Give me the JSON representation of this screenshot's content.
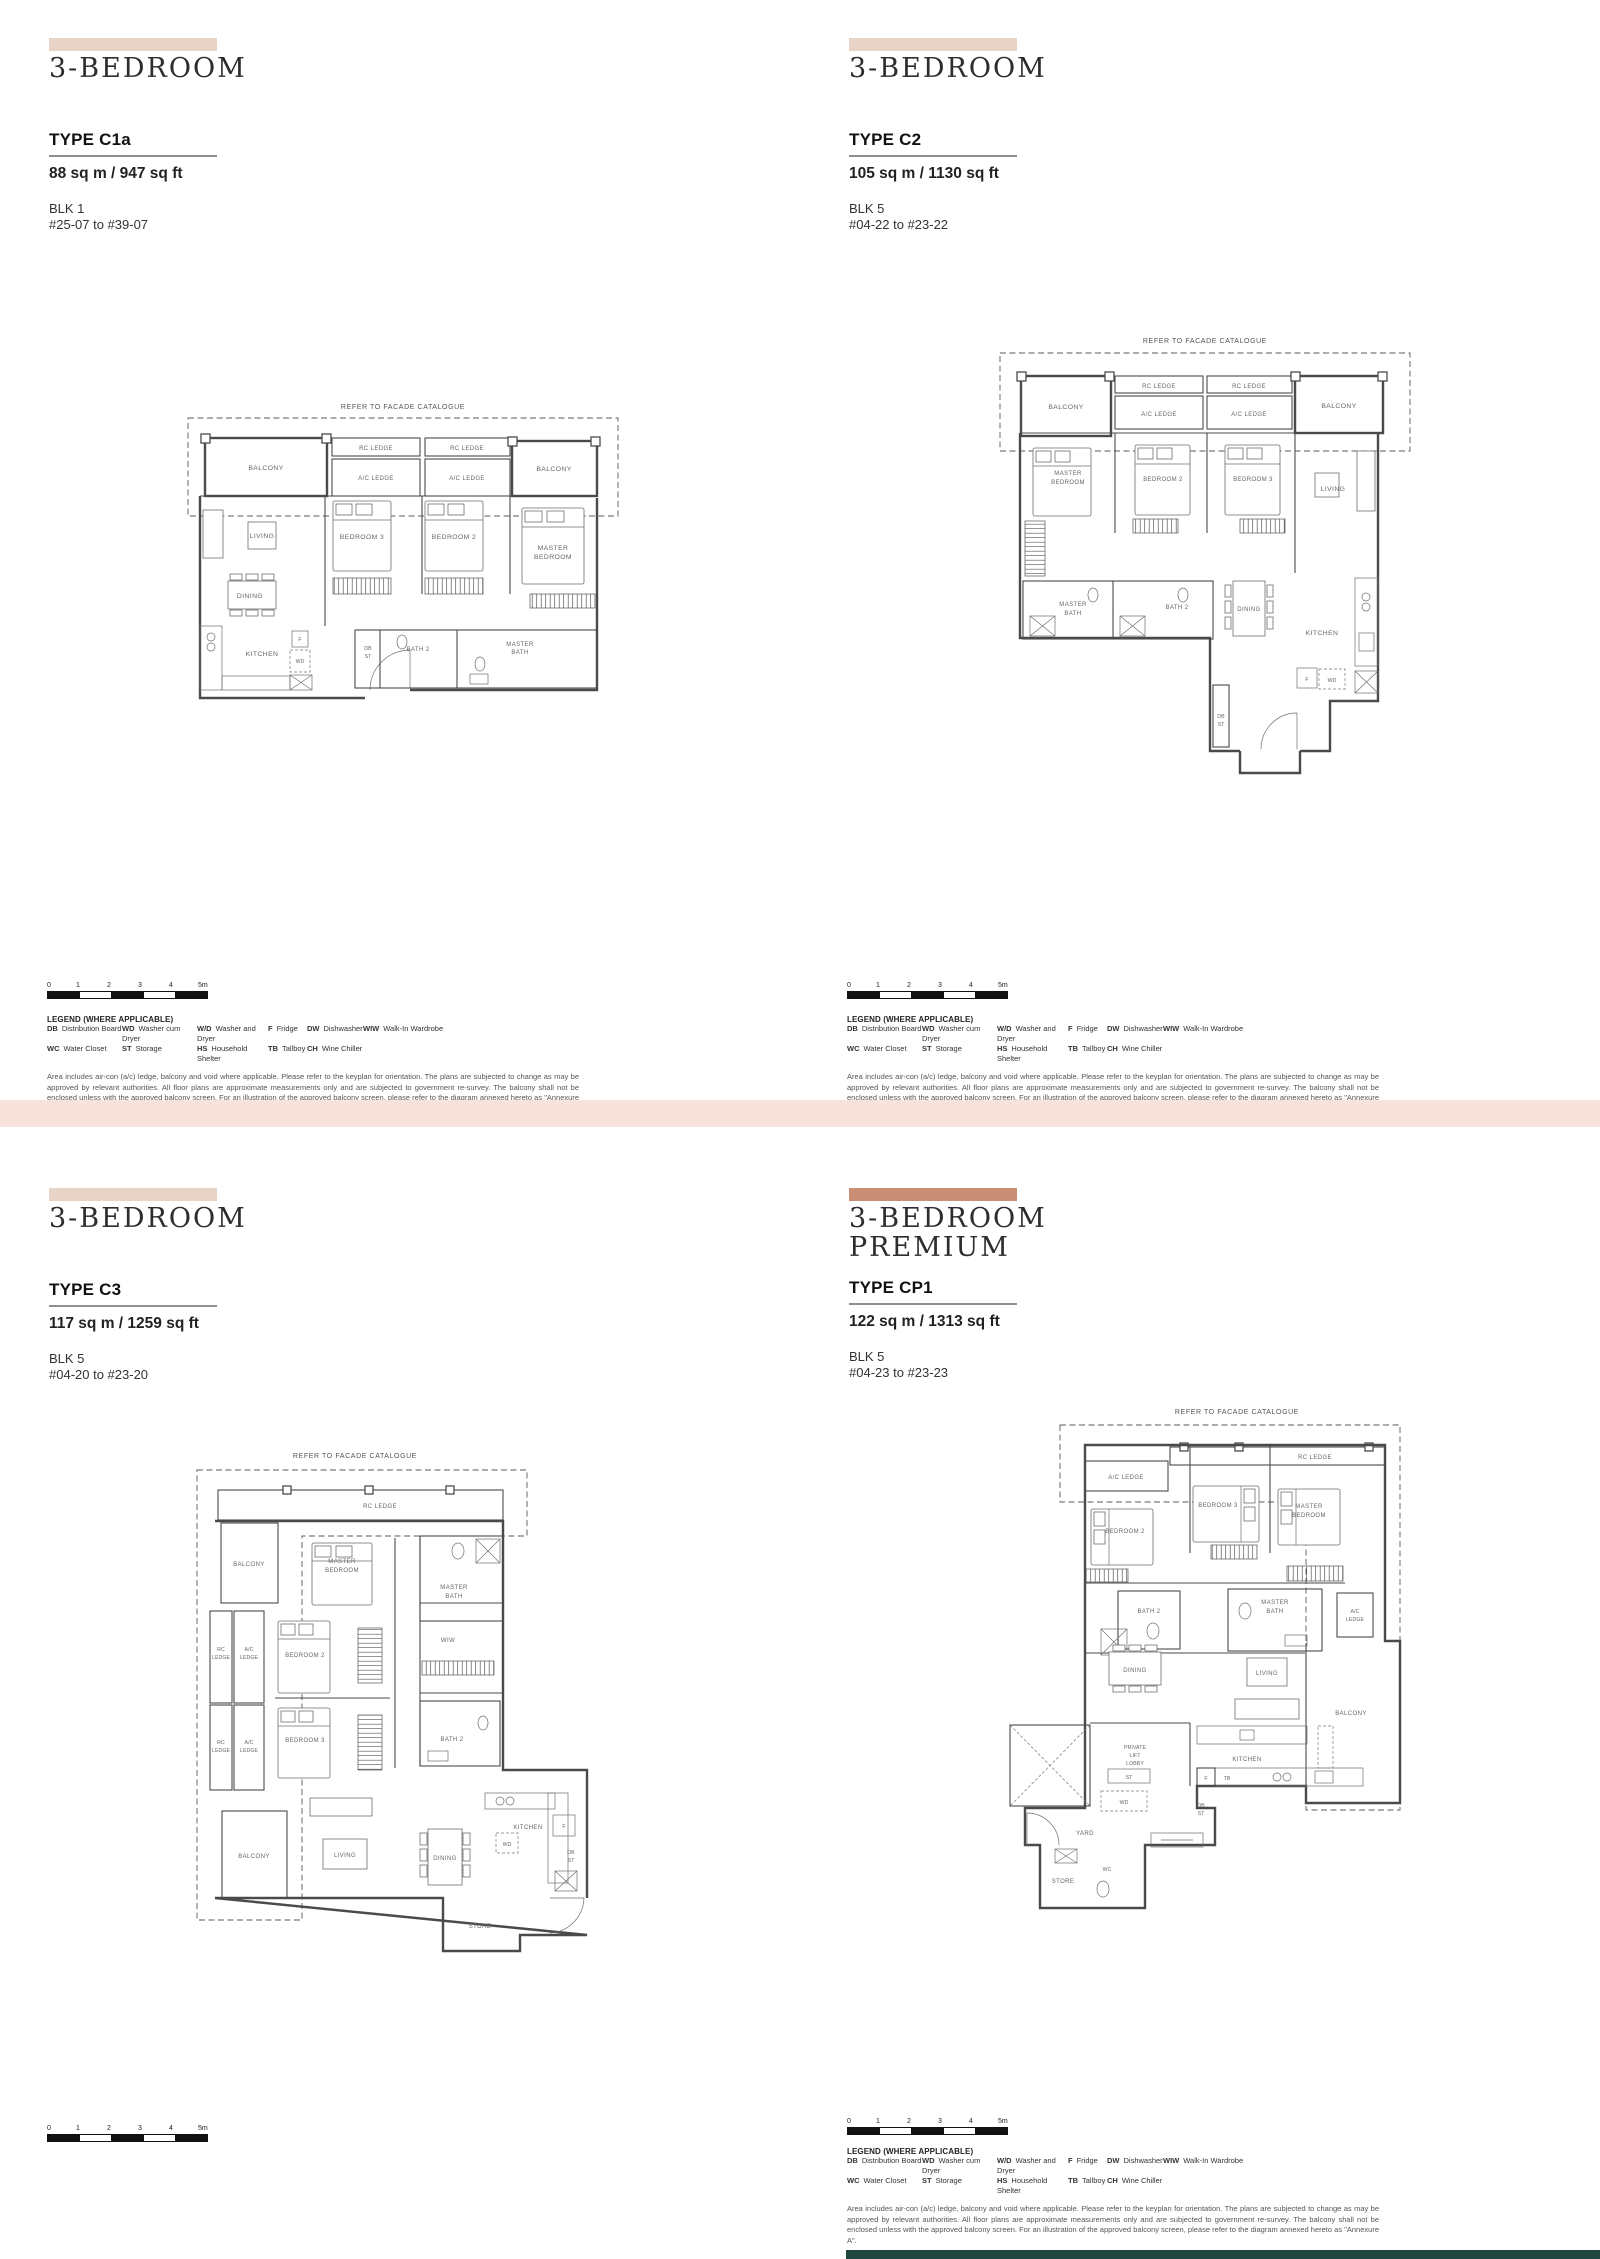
{
  "page": {
    "divider_color": "#f7e3dc",
    "footer_bar_color": "#20473f",
    "band_light": "#e8d4c7",
    "band_premium": "#c98e76"
  },
  "shared": {
    "facade_note": "REFER TO FACADE CATALOGUE",
    "scale_ticks": [
      "0",
      "1",
      "2",
      "3",
      "4",
      "5m"
    ],
    "legend_title": "LEGEND (WHERE APPLICABLE)",
    "legend_row1": [
      {
        "abbr": "DB",
        "term": "Distribution Board"
      },
      {
        "abbr": "WD",
        "term": "Washer cum Dryer"
      },
      {
        "abbr": "W/D",
        "term": "Washer and Dryer"
      },
      {
        "abbr": "F",
        "term": "Fridge"
      },
      {
        "abbr": "DW",
        "term": "Dishwasher"
      },
      {
        "abbr": "WIW",
        "term": "Walk-In Wardrobe"
      }
    ],
    "legend_row2": [
      {
        "abbr": "WC",
        "term": "Water Closet"
      },
      {
        "abbr": "ST",
        "term": "Storage"
      },
      {
        "abbr": "HS",
        "term": "Household Shelter"
      },
      {
        "abbr": "TB",
        "term": "Tallboy"
      },
      {
        "abbr": "CH",
        "term": "Wine Chiller"
      }
    ],
    "disclaimer": "Area includes air-con (a/c) ledge, balcony and void where applicable. Please refer to the keyplan for orientation. The plans are subjected to change as may be approved by relevant authorities. All floor plans are approximate measurements only and are subjected to government re-survey. The balcony shall not be enclosed unless with the approved balcony screen. For an illustration of the approved balcony screen, please refer to the diagram annexed hereto as \"Annexure A\"."
  },
  "labels": {
    "balcony": "BALCONY",
    "rc_ledge": "RC LEDGE",
    "ac_ledge": "A/C LEDGE",
    "rc": "RC",
    "ac": "A/C",
    "ledge": "LEDGE",
    "living": "LIVING",
    "dining": "DINING",
    "kitchen": "KITCHEN",
    "bedroom2": "BEDROOM 2",
    "bedroom3": "BEDROOM 3",
    "master": "MASTER",
    "bedroom": "BEDROOM",
    "bath": "BATH",
    "bath2": "BATH 2",
    "wiw": "WIW",
    "db": "DB",
    "st": "ST",
    "f": "F",
    "wd": "WD",
    "tb": "TB",
    "wc": "WC",
    "private": "PRIVATE",
    "lift": "LIFT",
    "lobby": "LOBBY",
    "store": "STORE",
    "yard": "YARD"
  },
  "panels": {
    "c1a": {
      "title": "3-BEDROOM",
      "type": "TYPE C1a",
      "area": "88 sq m / 947 sq ft",
      "block": "BLK 1",
      "floors": "#25-07 to #39-07"
    },
    "c2": {
      "title": "3-BEDROOM",
      "type": "TYPE C2",
      "area": "105 sq m / 1130 sq ft",
      "block": "BLK 5",
      "floors": "#04-22 to #23-22"
    },
    "c3": {
      "title": "3-BEDROOM",
      "type": "TYPE C3",
      "area": "117 sq m / 1259 sq ft",
      "block": "BLK 5",
      "floors": "#04-20 to #23-20"
    },
    "cp1": {
      "title": "3-BEDROOM",
      "title2": "PREMIUM",
      "type": "TYPE CP1",
      "area": "122 sq m / 1313 sq ft",
      "block": "BLK 5",
      "floors": "#04-23 to #23-23"
    }
  }
}
